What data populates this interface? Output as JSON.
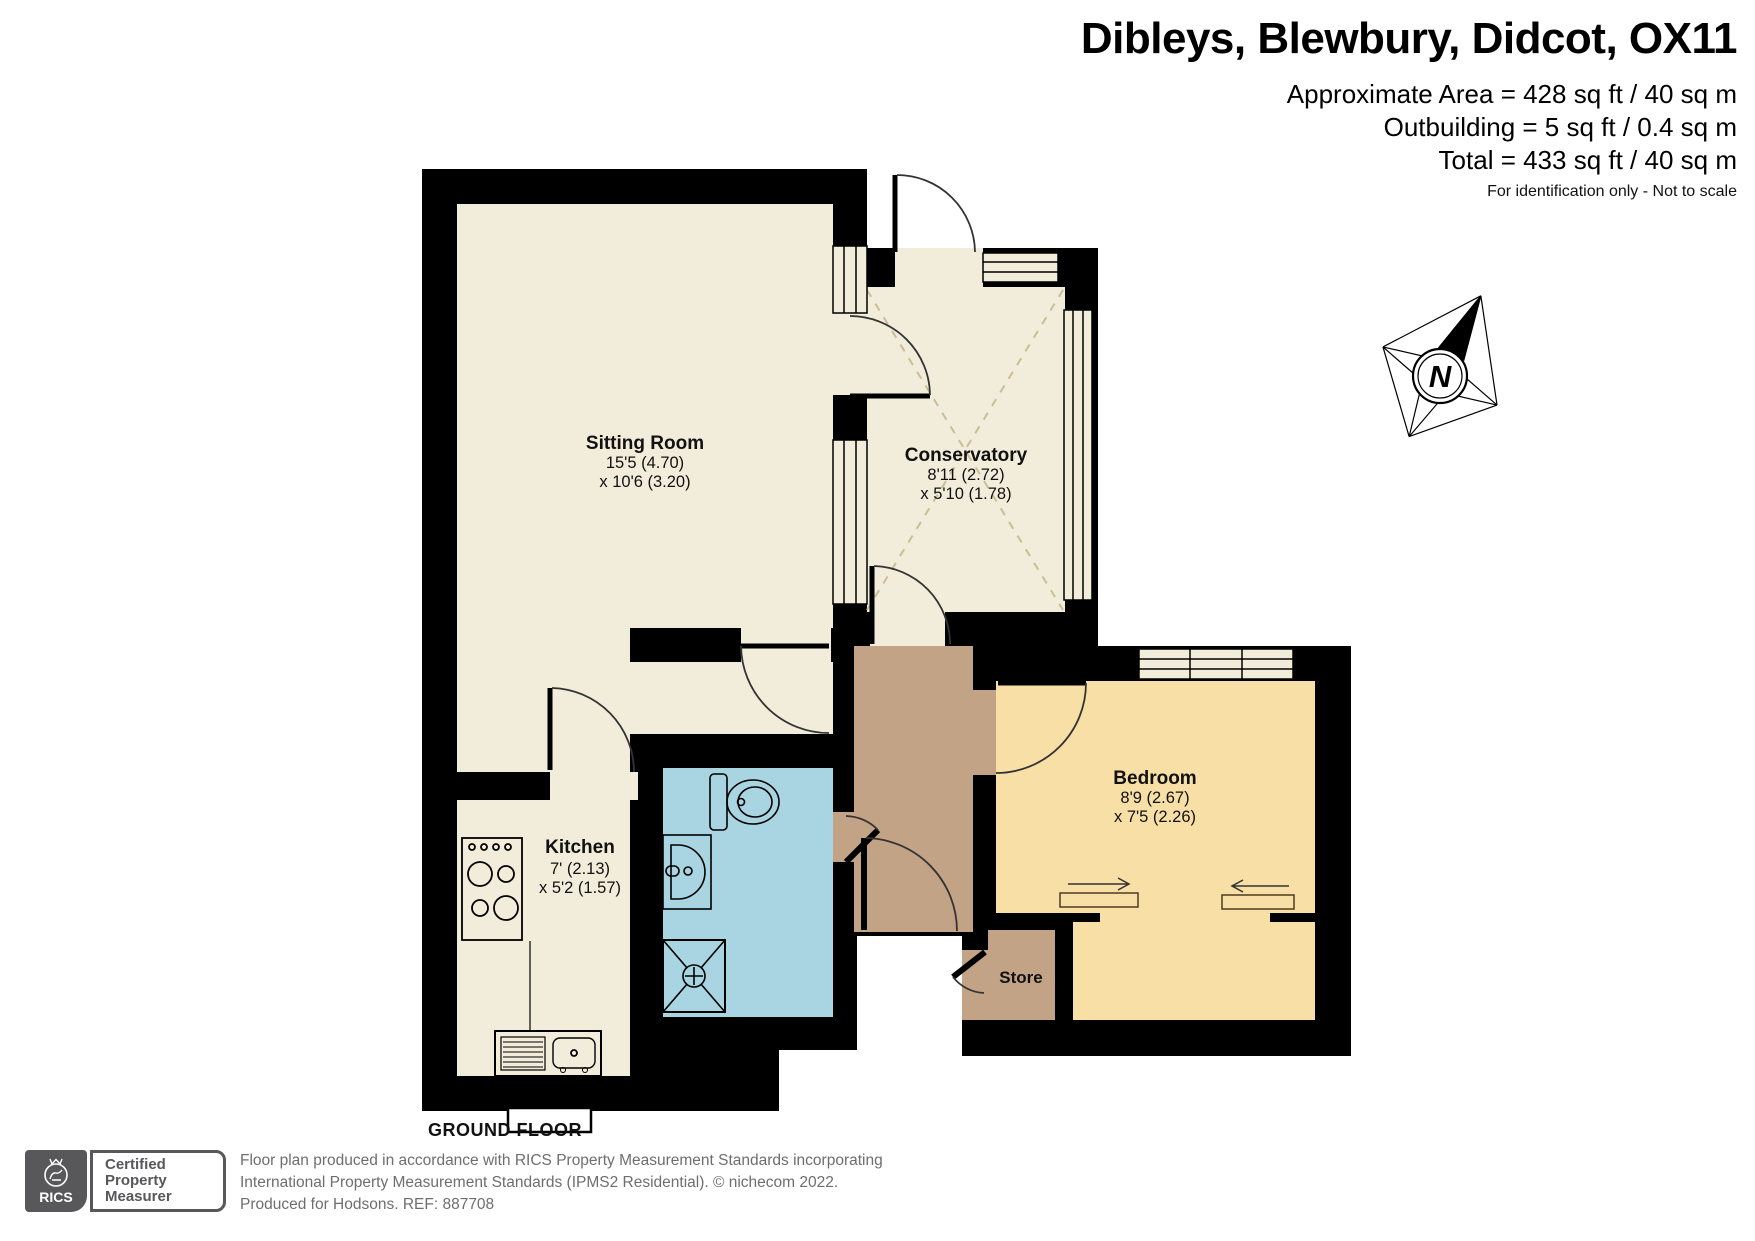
{
  "header": {
    "title": "Dibleys, Blewbury, Didcot, OX11",
    "area": "Approximate Area = 428 sq ft / 40 sq m",
    "outbuilding": "Outbuilding = 5 sq ft / 0.4 sq m",
    "total": "Total = 433 sq ft / 40 sq m",
    "note": "For identification only - Not to scale"
  },
  "plan": {
    "floor_label": "GROUND FLOOR",
    "compass_letter": "N",
    "rooms": {
      "sitting": {
        "name": "Sitting Room",
        "dims": [
          "15'5 (4.70)",
          "x 10'6 (3.20)"
        ]
      },
      "conservatory": {
        "name": "Conservatory",
        "dims": [
          "8'11 (2.72)",
          "x 5'10 (1.78)"
        ]
      },
      "kitchen": {
        "name": "Kitchen",
        "dims": [
          "7' (2.13)",
          "x 5'2 (1.57)"
        ]
      },
      "bedroom": {
        "name": "Bedroom",
        "dims": [
          "8'9 (2.67)",
          "x 7'5 (2.26)"
        ]
      },
      "store": {
        "name": "Store"
      }
    },
    "colors": {
      "wall_black": "#000000",
      "room_cream": "#f1edda",
      "bathroom_blue": "#a9d4e1",
      "bedroom_peach": "#f7dfa6",
      "hall_brown": "#c3a385",
      "dash_tan": "#cbbd94"
    }
  },
  "footer": {
    "rics": "RICS",
    "badge": [
      "Certified",
      "Property",
      "Measurer"
    ],
    "line1": "Floor plan produced in accordance with RICS Property Measurement Standards incorporating",
    "line2": "International Property Measurement Standards (IPMS2 Residential).   © nichecom 2022.",
    "line3": "Produced for Hodsons.   REF: 887708"
  }
}
